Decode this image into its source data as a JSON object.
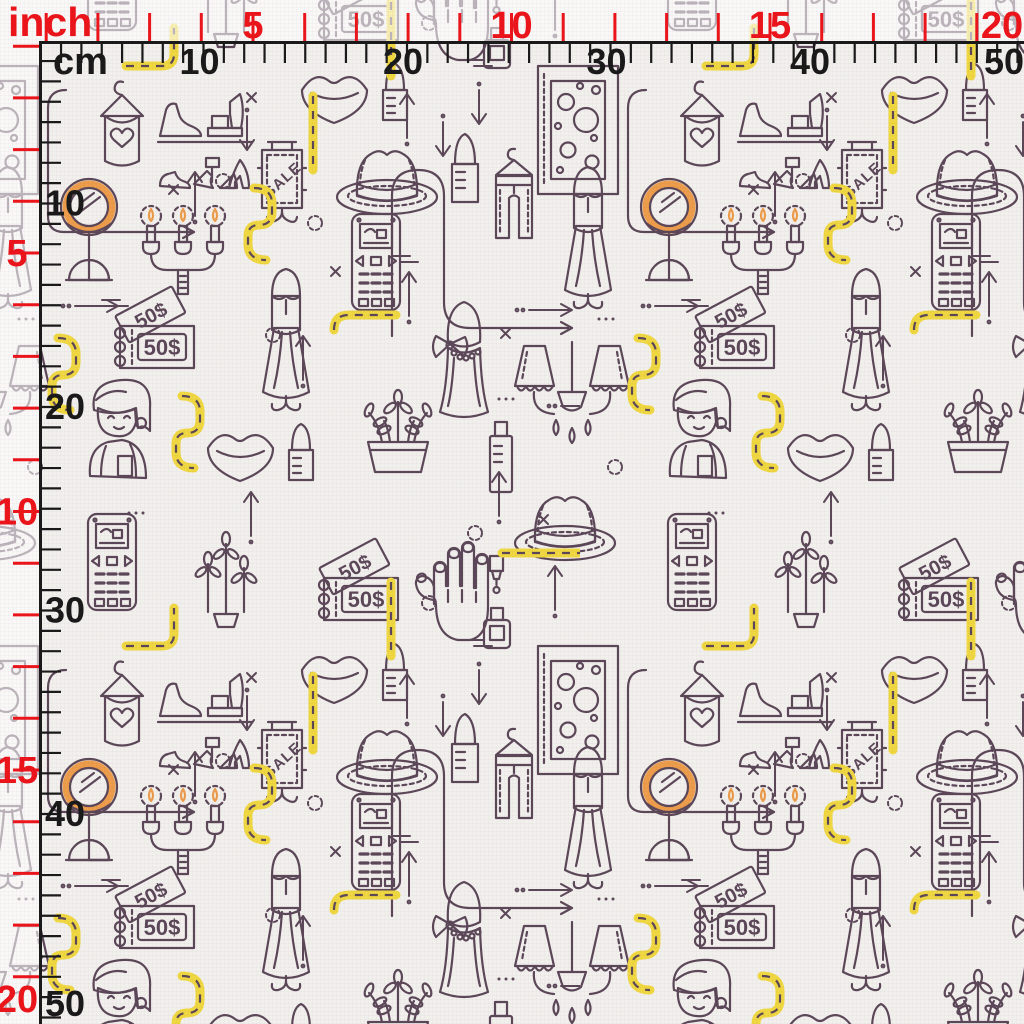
{
  "meta": {
    "description": "Seamless fashion shopping fabric pattern preview with inch and cm rulers"
  },
  "rulers": {
    "corner": {
      "inch_label": "inch",
      "cm_label": "cm"
    },
    "inch": {
      "color": "#ee1117",
      "px_per_unit": 51.7,
      "tick_offset": -5.5,
      "numbers": [
        5,
        10,
        15,
        20
      ],
      "minor_from": 1,
      "minor_to": 19
    },
    "cm": {
      "color": "#161616",
      "px_per_unit": 20.35,
      "numbers": [
        10,
        20,
        30,
        40,
        50
      ],
      "minor_from": 2,
      "minor_to": 50
    },
    "geometry": {
      "top_line_y": 42,
      "left_line_x": 40,
      "size": 1024
    }
  },
  "pattern": {
    "background": "#f4f2ef",
    "palette": {
      "ink": "#5a4557",
      "red": "#e65a6e",
      "red_deep": "#cf4257",
      "yellow": "#f2d93f",
      "blue": "#54a7d7",
      "blue_light": "#6db9e0",
      "orange": "#ef9d49",
      "tan": "#f7cb92",
      "white": "#ffffff"
    },
    "texts": {
      "sale": "SALE",
      "ticket_front": "50$",
      "ticket_back": "50$"
    },
    "tile": {
      "w": 580,
      "h": 580
    },
    "motifs": [
      {
        "n": "tank-top",
        "x": 95,
        "y": 80
      },
      {
        "n": "shoes",
        "x": 156,
        "y": 90
      },
      {
        "n": "lips",
        "x": 296,
        "y": 66
      },
      {
        "n": "lipstick-sm",
        "x": 380,
        "y": 60
      },
      {
        "n": "sale",
        "x": 256,
        "y": 138
      },
      {
        "n": "hat",
        "x": 334,
        "y": 140
      },
      {
        "n": "lipstick-lg",
        "x": 448,
        "y": 130
      },
      {
        "n": "jeans",
        "x": 488,
        "y": 146
      },
      {
        "n": "frame",
        "x": 536,
        "y": 64
      },
      {
        "n": "frame",
        "x": -44,
        "y": 64
      },
      {
        "n": "gown",
        "x": 560,
        "y": 164
      },
      {
        "n": "gown",
        "x": -20,
        "y": 164
      },
      {
        "n": "gown",
        "x": 258,
        "y": 266
      },
      {
        "n": "mirror",
        "x": 58,
        "y": 176
      },
      {
        "n": "candelabra",
        "x": 138,
        "y": 196
      },
      {
        "n": "phone",
        "x": 350,
        "y": 212
      },
      {
        "n": "tickets",
        "x": 110,
        "y": 288
      },
      {
        "n": "bust",
        "x": 432,
        "y": 296
      },
      {
        "n": "lamp",
        "x": 512,
        "y": 340
      },
      {
        "n": "lamp",
        "x": -68,
        "y": 340
      },
      {
        "n": "person",
        "x": 82,
        "y": 374
      },
      {
        "n": "lips",
        "x": 202,
        "y": 424
      },
      {
        "n": "lipstick-sm",
        "x": 286,
        "y": 420
      },
      {
        "n": "plant-pot",
        "x": 352,
        "y": 384
      },
      {
        "n": "blue-tube",
        "x": 486,
        "y": 420
      },
      {
        "n": "hat",
        "x": 512,
        "y": 486
      },
      {
        "n": "hat",
        "x": -68,
        "y": 486
      },
      {
        "n": "phone",
        "x": 86,
        "y": 512
      },
      {
        "n": "phone",
        "x": 86,
        "y": -68
      },
      {
        "n": "plant-sprigs",
        "x": 188,
        "y": 516
      },
      {
        "n": "plant-sprigs",
        "x": 188,
        "y": -64
      },
      {
        "n": "tickets",
        "x": 314,
        "y": 540
      },
      {
        "n": "tickets",
        "x": 314,
        "y": -40
      },
      {
        "n": "hand",
        "x": 410,
        "y": 534
      },
      {
        "n": "hand",
        "x": 410,
        "y": -46
      },
      {
        "n": "meander-a",
        "x": 46,
        "y": 88
      },
      {
        "n": "meander-b",
        "x": 390,
        "y": 150
      },
      {
        "n": "ypath-a",
        "x": 124,
        "y": 24
      },
      {
        "n": "ypath-b",
        "x": 246,
        "y": 184
      },
      {
        "n": "ypath-b",
        "x": 630,
        "y": 334
      },
      {
        "n": "ypath-b",
        "x": 50,
        "y": 334
      },
      {
        "n": "ypath-d",
        "x": 330,
        "y": 306
      },
      {
        "n": "ypath-b",
        "x": 174,
        "y": 392
      },
      {
        "n": "ypath-c",
        "x": 384,
        "y": 578
      },
      {
        "n": "ypath-c",
        "x": 384,
        "y": -2
      },
      {
        "n": "ypath-c",
        "x": 306,
        "y": 92
      },
      {
        "n": "ypath-e",
        "x": 498,
        "y": 546
      },
      {
        "n": "arrow-up",
        "x": 186,
        "y": 162
      },
      {
        "n": "arrow-up",
        "x": 400,
        "y": 262
      },
      {
        "n": "arrow-up",
        "x": 294,
        "y": 326
      },
      {
        "n": "arrow-up",
        "x": 490,
        "y": 462
      },
      {
        "n": "arrow-up",
        "x": 242,
        "y": 482
      },
      {
        "n": "arrow-up",
        "x": 546,
        "y": 556
      },
      {
        "n": "arrow-up",
        "x": 546,
        "y": -24
      },
      {
        "n": "arrow-up",
        "x": 398,
        "y": 84
      },
      {
        "n": "arrow-down",
        "x": 238,
        "y": 108
      },
      {
        "n": "arrow-down",
        "x": 470,
        "y": 82
      },
      {
        "n": "arrow-down",
        "x": 434,
        "y": 114
      },
      {
        "n": "arrow-right",
        "x": 514,
        "y": 302
      },
      {
        "n": "arrow-right",
        "x": 546,
        "y": 398
      },
      {
        "n": "arrow-right",
        "x": 60,
        "y": 298
      },
      {
        "n": "x-mark",
        "x": 246,
        "y": 92
      },
      {
        "n": "x-mark",
        "x": 168,
        "y": 184
      },
      {
        "n": "x-mark",
        "x": 330,
        "y": 266
      },
      {
        "n": "x-mark",
        "x": 500,
        "y": 328
      },
      {
        "n": "x-mark",
        "x": 538,
        "y": 514
      },
      {
        "n": "ring",
        "x": 306,
        "y": 214
      },
      {
        "n": "ring",
        "x": 466,
        "y": 524
      },
      {
        "n": "ring",
        "x": 264,
        "y": 326
      },
      {
        "n": "ring",
        "x": 420,
        "y": 594
      },
      {
        "n": "ring",
        "x": 420,
        "y": 14
      },
      {
        "n": "ring",
        "x": 26,
        "y": 458
      },
      {
        "n": "ring",
        "x": 214,
        "y": 172
      },
      {
        "n": "dots3",
        "x": 496,
        "y": 396
      },
      {
        "n": "dots3",
        "x": 126,
        "y": 510
      },
      {
        "n": "dots3",
        "x": 16,
        "y": 316
      },
      {
        "n": "dash2",
        "x": 390,
        "y": 252
      },
      {
        "n": "dash2",
        "x": 100,
        "y": 296
      },
      {
        "n": "dash2",
        "x": 464,
        "y": 56
      }
    ]
  }
}
